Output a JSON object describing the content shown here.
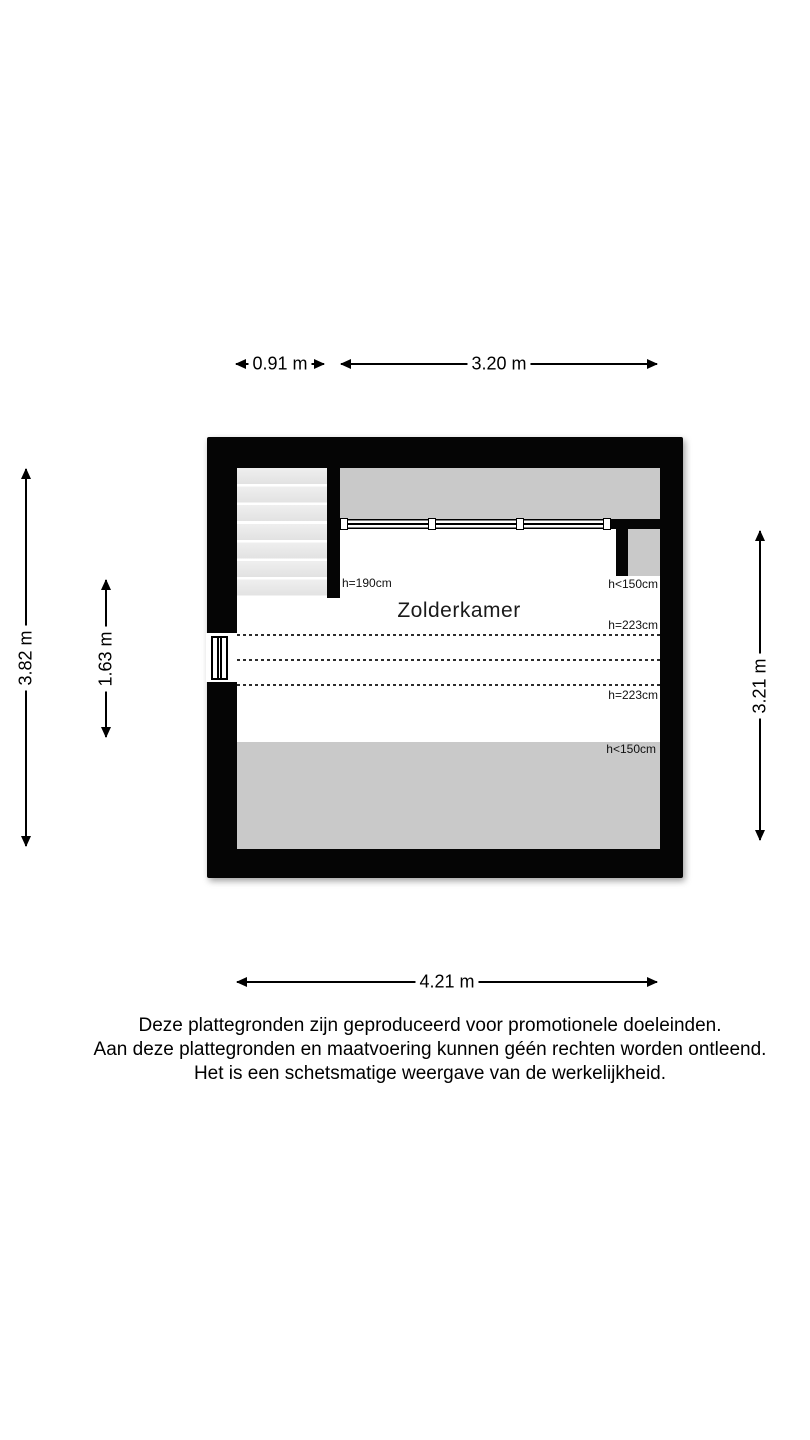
{
  "floorplan": {
    "room_label": "Zolderkamer",
    "dimensions": {
      "stair_width": "0.91 m",
      "upper_width": "3.20 m",
      "total_depth": "3.82 m",
      "inner_depth": "1.63 m",
      "right_depth": "3.21 m",
      "total_width": "4.21 m"
    },
    "height_labels": {
      "stair_wall": "h=190cm",
      "dormer_side": "h<150cm",
      "ceiling_upper": "h=223cm",
      "ceiling_lower": "h=223cm",
      "roof_bottom": "h<150cm"
    },
    "colors": {
      "wall": "#050505",
      "low_ceiling_area": "#c9c9c9",
      "stair_tread": "#e8e8e8",
      "background": "#ffffff"
    }
  },
  "footer": {
    "lines": [
      "Deze plattegronden zijn geproduceerd voor promotionele doeleinden.",
      "Aan deze plattegronden en maatvoering kunnen géén rechten worden ontleend.",
      "Het is een schetsmatige weergave van de werkelijkheid."
    ]
  }
}
